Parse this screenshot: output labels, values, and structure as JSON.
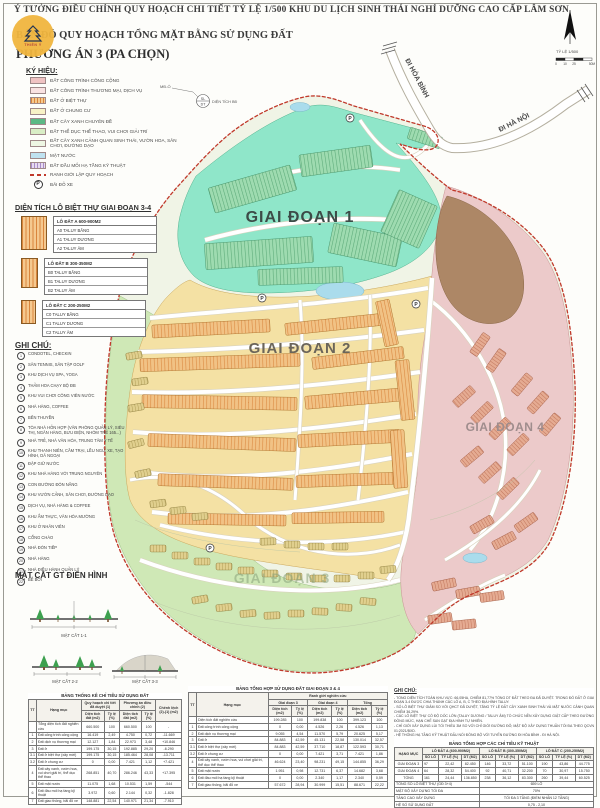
{
  "header": {
    "line1": "Ý TƯỞNG ĐIỀU CHỈNH QUY HOẠCH CHI TIẾT TỶ LỆ 1/500 KHU DU LỊCH SINH THÁI NGHỈ DƯỠNG CAO CẤP LÂM SƠN",
    "line2": "BẢN ĐỒ QUY HOẠCH TỔNG MẶT BẰNG SỬ DỤNG ĐẤT",
    "line3": "PHƯƠNG ÁN 3 (PA CHỌN)",
    "logo_text": "THIÊN Ý"
  },
  "legend": {
    "title": "KÝ HIỆU:",
    "items": [
      {
        "label": "ĐẤT CÔNG TRÌNH CÔNG CỘNG",
        "type": "fill",
        "color": "#f0c3c3"
      },
      {
        "label": "ĐẤT CÔNG TRÌNH THƯƠNG MẠI, DỊCH VỤ",
        "type": "fill",
        "color": "#f9e2e2"
      },
      {
        "label": "ĐẤT Ở BIỆT THỰ",
        "type": "hatch",
        "color": "#f5c98f",
        "stripe": "#d9853c"
      },
      {
        "label": "ĐẤT Ở CHUNG CƯ",
        "type": "fill",
        "color": "#f8f2c6"
      },
      {
        "label": "ĐẤT CÂY XANH CHUYÊN ĐỀ",
        "type": "fill",
        "color": "#5cb985"
      },
      {
        "label": "ĐẤT THỂ DỤC THỂ THAO, VUI CHƠI GIẢI TRÍ",
        "type": "fill",
        "color": "#d9eec6"
      },
      {
        "label": "ĐẤT CÂY XANH CẢNH QUAN SINH THÁI, VƯỜN HOA, SÂN CHƠI, ĐƯỜNG DẠO",
        "type": "fill",
        "color": "#eef7e4"
      },
      {
        "label": "MẶT NƯỚC",
        "type": "fill",
        "color": "#bfe2f0"
      },
      {
        "label": "ĐẤT ĐẦU MỐI HẠ TẦNG KỸ THUẬT",
        "type": "hatch",
        "color": "#e7dbf0",
        "stripe": "#a98cc9"
      },
      {
        "label": "RANH GIỚI LẬP QUY HOẠCH",
        "type": "boundary",
        "color": "#c0392b"
      },
      {
        "label": "BÃI ĐỖ XE",
        "type": "parking",
        "color": "#333333"
      }
    ]
  },
  "lot_callout": {
    "top_label": "MĐ-Ổ",
    "circle_top": "SL",
    "circle_bottom": "DT",
    "caption": "DIỆN TÍCH BĐ"
  },
  "villa_section": {
    "title": "DIỆN TÍCH LÔ BIỆT THỰ GIAI ĐOẠN 3-4",
    "groups": [
      {
        "name": "LÔ ĐẤT A 600-900M2",
        "rows": [
          "A0 TALUY BẰNG",
          "A1 TALUY DƯƠNG",
          "A2 TALUY ÂM"
        ]
      },
      {
        "name": "LÔ ĐẤT B 300-350M2",
        "rows": [
          "B0 TALUY BẰNG",
          "B1 TALUY DƯƠNG",
          "B2 TALUY ÂM"
        ]
      },
      {
        "name": "LÔ ĐẤT C 200-250M2",
        "rows": [
          "C0 TALUY BẰNG",
          "C1 TALUY DƯƠNG",
          "C2 TALUY ÂM"
        ]
      }
    ]
  },
  "notes": {
    "title": "GHI CHÚ:",
    "items": [
      "CONDOTEL, CHECKIN",
      "SÂN TENNIS, SÂN TẬP GOLF",
      "KHU DỊCH VỤ SPA, YOGA",
      "THẢM HOA CHẠY BỘ ĐB",
      "KHU VUI CHƠI CÔNG VIÊN NƯỚC",
      "NHÀ HÀNG, COFFEE",
      "BẾN THUYỀN",
      "TÒA NHÀ HỖN HỢP (VĂN PHÒNG QUẢN LÝ, SIÊU THỊ, NGÂN HÀNG, BƯU ĐIỆN, NHÓM TRẺ 165...)",
      "NHÀ TRẺ, NHÀ VĂN HÓA, TRUNG TÂM Y TẾ",
      "KHU THANH NIÊN, CẮM TRẠI, LỀU NGỦ, XE, TẠO HÌNH, DÃ NGOẠI",
      "ĐẬP GIỮ NƯỚC",
      "KHU NHÀ HÀNG VỚI TRUNG NGUYÊN",
      "CON ĐƯỜNG ĐÓN NẮNG",
      "KHU VƯỜN CẢNH, SÂN CHƠI, ĐƯỜNG DẠO",
      "DỊCH VỤ, NHÀ HÀNG & COFFEE",
      "KHU ẨM THỰC, VĂN HÓA MƯỜNG",
      "KHU Ở NHÂN VIÊN",
      "CỔNG CHÀO",
      "NHÀ ĐÓN TIẾP",
      "NHÀ HÀNG",
      "NHÀ ĐIỀU HÀNH QUẢN LÝ",
      "BỂ BƠI"
    ]
  },
  "sections": {
    "title": "MẶT CẮT GT ĐIỂN HÌNH",
    "labels": [
      "MẶT CẮT 1-1",
      "MẶT CẮT 2-2",
      "MẶT CẮT 3-3"
    ]
  },
  "map": {
    "phase1": "GIAI ĐOẠN 1",
    "phase2": "GIAI ĐOẠN 2",
    "phase3": "GIAI ĐOẠN 3",
    "phase4": "GIAI ĐOẠN 4",
    "road_north": "ĐI HÒA BÌNH",
    "road_east": "ĐI HÀ NỘI",
    "parking_letter": "P",
    "compass": {
      "scale_label": "TỶ LỆ 1/500",
      "ticks": [
        "0",
        "10",
        "25",
        "50M"
      ]
    }
  },
  "tables": {
    "left": {
      "title": "BẢNG THỐNG KÊ CHỈ TIÊU SỬ DỤNG ĐẤT",
      "head": [
        [
          {
            "t": "TT",
            "rs": 2
          },
          {
            "t": "Hạng mục",
            "rs": 2
          },
          {
            "t": "Quy hoạch chi tiết đã duyệt (1)",
            "cs": 2
          },
          {
            "t": "Phương án điều chỉnh (2)",
            "cs": 2
          },
          {
            "t": "Chênh lệch (2)-(1) (m2)",
            "rs": 2
          }
        ],
        [
          {
            "t": "Diện tích đất (m2)"
          },
          {
            "t": "Tỷ lệ (%)"
          },
          {
            "t": "Diện tích đất (m2)"
          },
          {
            "t": "Tỷ lệ (%)"
          }
        ]
      ],
      "body": [
        [
          "",
          "Tổng diện tích đất nghiên cứu",
          "660.500",
          "100",
          "660.500",
          "100",
          "-"
        ],
        [
          "1",
          "Đất công trình công cộng",
          "16.419",
          "2,49",
          "4.750",
          "0,72",
          "-11.669"
        ],
        [
          "2",
          "Đất dịch vụ thương mại",
          "12.127",
          "1,84",
          "22.973",
          "3,48",
          "+10.846"
        ],
        [
          "3",
          "Đất ở",
          "199.175",
          "30,15",
          "192.885",
          "29,20",
          "-6.290"
        ],
        [
          "3.1",
          "Đất ở biệt thự (xây mới)",
          "199.175",
          "30,15",
          "185.464",
          "28,08",
          "-13.711"
        ],
        [
          "3.2",
          "Đất ở chung cư",
          "0",
          "0,00",
          "7.421",
          "1,12",
          "+7.421"
        ],
        [
          "4",
          "Đất cây xanh, vườn hoa, vui chơi giải trí, thể dục thể thao",
          "268.851",
          "40,70",
          "286.246",
          "43,33",
          "+17.395"
        ],
        [
          "5",
          "Đất mặt nước",
          "11.075",
          "1,68",
          "10.531",
          "1,59",
          "-544"
        ],
        [
          "6",
          "Đất đầu mối hạ tầng kỹ thuật",
          "3.972",
          "0,60",
          "2.144",
          "0,32",
          "-1.828"
        ],
        [
          "7",
          "Đất giao thông, bãi đỗ xe",
          "148.881",
          "22,54",
          "140.971",
          "21,34",
          "-7.910"
        ]
      ]
    },
    "middle": {
      "title": "BẢNG TỔNG HỢP SỬ DỤNG ĐẤT GIAI ĐOẠN 3 & 4",
      "head": [
        [
          {
            "t": "TT",
            "rs": 3
          },
          {
            "t": "Hạng mục",
            "rs": 3
          },
          {
            "t": "Ranh giới nghiên cứu",
            "cs": 6
          }
        ],
        [
          {
            "t": "Giai đoạn 3",
            "cs": 2
          },
          {
            "t": "Giai đoạn 4",
            "cs": 2
          },
          {
            "t": "Tổng",
            "cs": 2
          }
        ],
        [
          {
            "t": "Diện tích (m2)"
          },
          {
            "t": "Tỷ lệ (%)"
          },
          {
            "t": "Diện tích (m2)"
          },
          {
            "t": "Tỷ lệ (%)"
          },
          {
            "t": "Diện tích (m2)"
          },
          {
            "t": "Tỷ lệ (%)"
          }
        ]
      ],
      "body": [
        [
          "",
          "Diện tích đất nghiên cứu",
          "199.285",
          "100",
          "199.838",
          "100",
          "399.123",
          "100"
        ],
        [
          "1",
          "Đất công trình công cộng",
          "0",
          "0,00",
          "4.526",
          "2,26",
          "4.526",
          "1,13"
        ],
        [
          "2",
          "Đất dịch vụ thương mại",
          "9.055",
          "4,54",
          "11.570",
          "5,79",
          "20.625",
          "5,17"
        ],
        [
          "3",
          "Đất ở",
          "84.883",
          "42,59",
          "45.131",
          "22,58",
          "130.014",
          "32,57"
        ],
        [
          "3.1",
          "Đất ở biệt thự (xây mới)",
          "84.883",
          "42,59",
          "37.710",
          "18,87",
          "122.593",
          "30,71"
        ],
        [
          "3.2",
          "Đất ở chung cư",
          "0",
          "0,00",
          "7.421",
          "3,71",
          "7.421",
          "1,86"
        ],
        [
          "4",
          "Đất cây xanh, vườn hoa, vui chơi giải trí, thể dục thể thao",
          "46.624",
          "23,40",
          "98.231",
          "49,15",
          "144.855",
          "36,29"
        ],
        [
          "5",
          "Đất mặt nước",
          "1.951",
          "0,98",
          "12.731",
          "6,37",
          "14.682",
          "3,68"
        ],
        [
          "6",
          "Đất đầu mối hạ tầng kỹ thuật",
          "0",
          "0,00",
          "2.340",
          "1,17",
          "2.340",
          "0,59"
        ],
        [
          "7",
          "Đất giao thông, bãi đỗ xe",
          "57.672",
          "28,94",
          "30.999",
          "15,51",
          "88.671",
          "22,22"
        ]
      ]
    },
    "right": {
      "title": "BẢNG TỔNG HỢP CÁC CHỈ TIÊU KỸ THUẬT",
      "head": [
        [
          {
            "t": "HẠNG MỤC",
            "rs": 2
          },
          {
            "t": "LÔ ĐẤT A (600-900M2)",
            "cs": 3
          },
          {
            "t": "LÔ ĐẤT B (300-350M2)",
            "cs": 3
          },
          {
            "t": "LÔ ĐẤT C (200-250M2)",
            "cs": 3
          }
        ],
        [
          {
            "t": "SỐ LÔ"
          },
          {
            "t": "TỶ LỆ (%)"
          },
          {
            "t": "DT (M2)"
          },
          {
            "t": "SỐ LÔ"
          },
          {
            "t": "TỶ LỆ (%)"
          },
          {
            "t": "DT (M2)"
          },
          {
            "t": "SỐ LÔ"
          },
          {
            "t": "TỶ LỆ (%)"
          },
          {
            "t": "DT (M2)"
          }
        ]
      ],
      "body": [
        [
          "GIAI ĐOẠN 3",
          "97",
          "22,42",
          "82.450",
          "146",
          "33,72",
          "51.100",
          "190",
          "43,86",
          "44.775"
        ],
        [
          "GIAI ĐOẠN 4",
          "64",
          "28,32",
          "54.400",
          "92",
          "40,71",
          "32.200",
          "70",
          "30,97",
          "15.750"
        ],
        [
          "TỔNG",
          "161",
          "24,44",
          "136.850",
          "238",
          "36,12",
          "83.300",
          "260",
          "39,44",
          "60.525"
        ]
      ],
      "summary": [
        [
          "TỔNG SỐ LÔ BIỆT THỰ (GĐ 3+4)",
          "659 LÔ"
        ],
        [
          "MẬT ĐỘ XÂY DỰNG TỐI ĐA",
          "70%"
        ],
        [
          "TẦNG CAO XÂY DỰNG",
          "TỐI ĐA 3 TẦNG (ĐIỂM NHẤN 12 TẦNG)"
        ],
        [
          "HỆ SỐ SỬ DỤNG ĐẤT",
          "0,75 - 2,10"
        ]
      ]
    }
  },
  "bottom_notes": {
    "title": "GHI CHÚ:",
    "lines": [
      "- TỔNG DIỆN TÍCH TOÀN KHU VỰC: 66,05HA, CHIẾM 81,77% TỔNG DT ĐẤT THEO ĐA ĐÃ DUYỆT. TRONG ĐÓ ĐẤT Ở GIAI ĐOẠN 3-4 ĐƯỢC CHIA THÀNH CÁC LÔ A, B, C THEO ĐỊA HÌNH TALUY.",
      "- SỐ LÔ BIỆT THỰ GIẢM SO VỚI QHCT ĐÃ DUYỆT, TĂNG TỶ LỆ ĐẤT CÂY XANH SINH THÁI VÀ MẶT NƯỚC CẢNH QUAN CHIẾM 36,29%.",
      "- CÁC LÔ BIỆT THỰ CÓ ĐỘ DỐC LỚN (TALUY DƯƠNG / TALUY ÂM) TỔ CHỨC NỀN XÂY DỰNG GIẬT CẤP THEO ĐƯỜNG ĐỒNG MỨC, HẠN CHẾ SAN GẠT ĐỊA HÌNH TỰ NHIÊN.",
      "- CHỈ GIỚI XÂY DỰNG LÙI TỐI THIỂU 3M SO VỚI CHỈ GIỚI ĐƯỜNG ĐỎ; MẬT ĐỘ XÂY DỰNG THUẦN TỐI ĐA THEO QCVN 01:2021/BXD.",
      "- HỆ THỐNG HẠ TẦNG KỸ THUẬT ĐẤU NỐI ĐỒNG BỘ VỚI TUYẾN ĐƯỜNG ĐI HÒA BÌNH - ĐI HÀ NỘI."
    ]
  }
}
